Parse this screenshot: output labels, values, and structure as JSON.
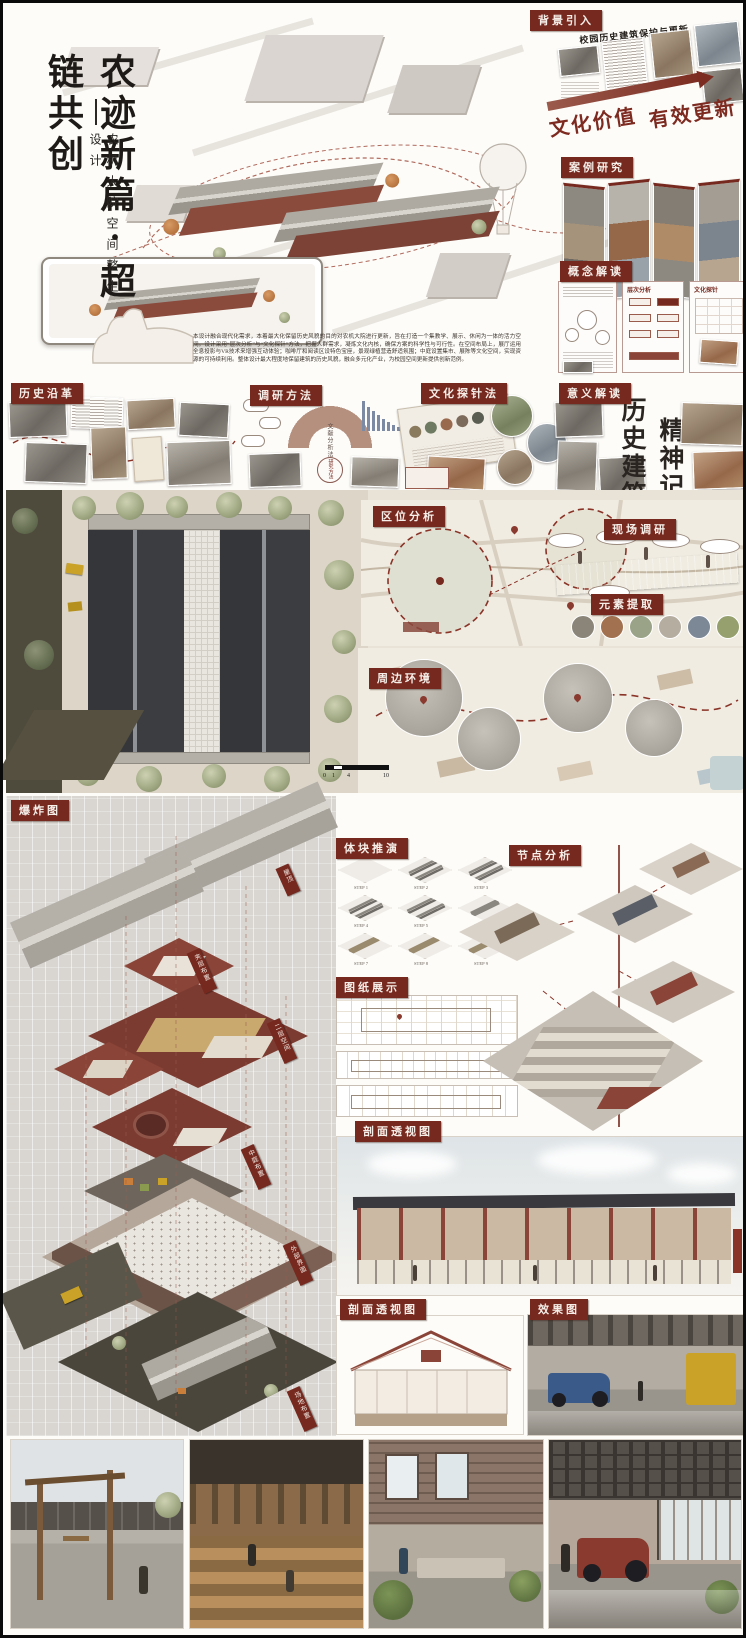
{
  "title": {
    "main": "农迹新篇·超链共创",
    "sub": "农机大院空间整生设计"
  },
  "intro": "本设计融合现代化需求，本着最大化保留历史风貌的目的对农机大院进行更新，旨在打造一个集教学、展示、休闲为一体的活力空间。设计采用“层次分析”与“文化探针”方法，把握人群需求，凝炼文化内核，确保方案的科学性与可行性。在空间布局上，展厅运用全息投影与VR技术来增强互动体验；咖啡厅和阅读区设特色宝座，景观绿植营造舒适氛围；中庭设置集市、展陈等文化空间，实现资源的可持续利用。整体设计最大程度地保留建筑的历史风貌，融合多元化产业，为校园空间更新提供创新范例。",
  "background": {
    "header": "背景引入",
    "title": "校园历史建筑保护与更新",
    "banner_left": "文化价值",
    "banner_right": "有效更新"
  },
  "case_study": {
    "header": "案例研究"
  },
  "concept": {
    "header": "概念解读",
    "panel_ahp": "层次分析",
    "panel_probe": "文化探针"
  },
  "history": {
    "header": "历史沿革"
  },
  "methods": {
    "header": "调研方法",
    "arc_label": "文献分析法",
    "hub_label": "研究方法"
  },
  "probe": {
    "header": "文化探针法"
  },
  "meaning": {
    "header": "意义解读",
    "big1": "历史建筑",
    "big2": "精神记忆"
  },
  "location": {
    "header": "区位分析"
  },
  "survey": {
    "header": "现场调研"
  },
  "elements": {
    "header": "元素提取"
  },
  "surround": {
    "header": "周边环境"
  },
  "scalebar": {
    "t0": "0",
    "t1": "1",
    "t2": "4",
    "t3": "10"
  },
  "exploded": {
    "header": "爆炸图",
    "labels": [
      "屋顶",
      "夹层布置",
      "二层空间",
      "中庭布置",
      "外部界面",
      "场地布置"
    ]
  },
  "massing": {
    "header": "体块推演",
    "steps": [
      "STEP 1",
      "STEP 2",
      "STEP 3",
      "STEP 4",
      "STEP 5",
      "STEP 6",
      "STEP 7",
      "STEP 8",
      "STEP 9"
    ]
  },
  "nodes": {
    "header": "节点分析"
  },
  "drawings": {
    "header": "图纸展示"
  },
  "section_a": {
    "header": "剖面透视图"
  },
  "section_b": {
    "header": "剖面透视图"
  },
  "render_view": {
    "header": "效果图"
  },
  "colors": {
    "accent": "#76291f",
    "banner": "#8a2f26",
    "paper": "#e9e3d7"
  }
}
